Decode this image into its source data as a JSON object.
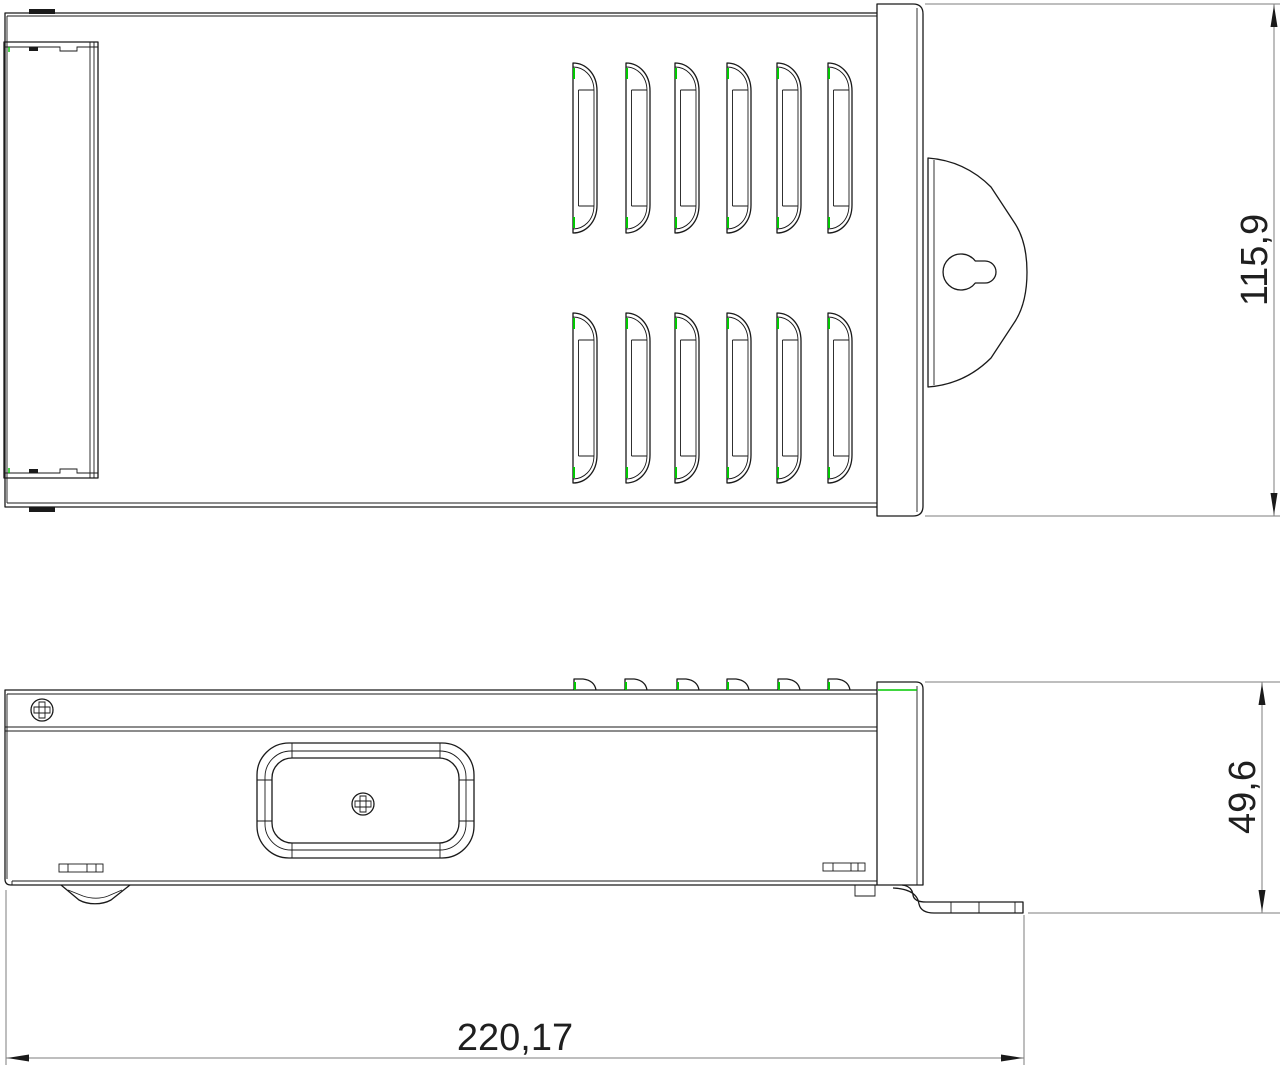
{
  "drawing": {
    "type": "technical-drawing",
    "views": {
      "top_view": "enclosure top view with vent louvers, terminal cover and keyhole mounting bracket",
      "side_view": "enclosure side view with screws, rounded access cutout and mounting foot"
    },
    "dimensions": {
      "top_view_width": "115,9",
      "side_view_height": "49,6",
      "overall_length": "220,17"
    },
    "colors": {
      "line": "#1a1a1a",
      "dimension_line": "#7d7d7d",
      "accent_green": "#00c800",
      "text": "#1f1f1f",
      "background": "#ffffff"
    },
    "icons": {
      "keyhole": "keyhole-slot-icon",
      "screw": "phillips-screw-icon",
      "louver": "vent-louver-icon"
    }
  }
}
